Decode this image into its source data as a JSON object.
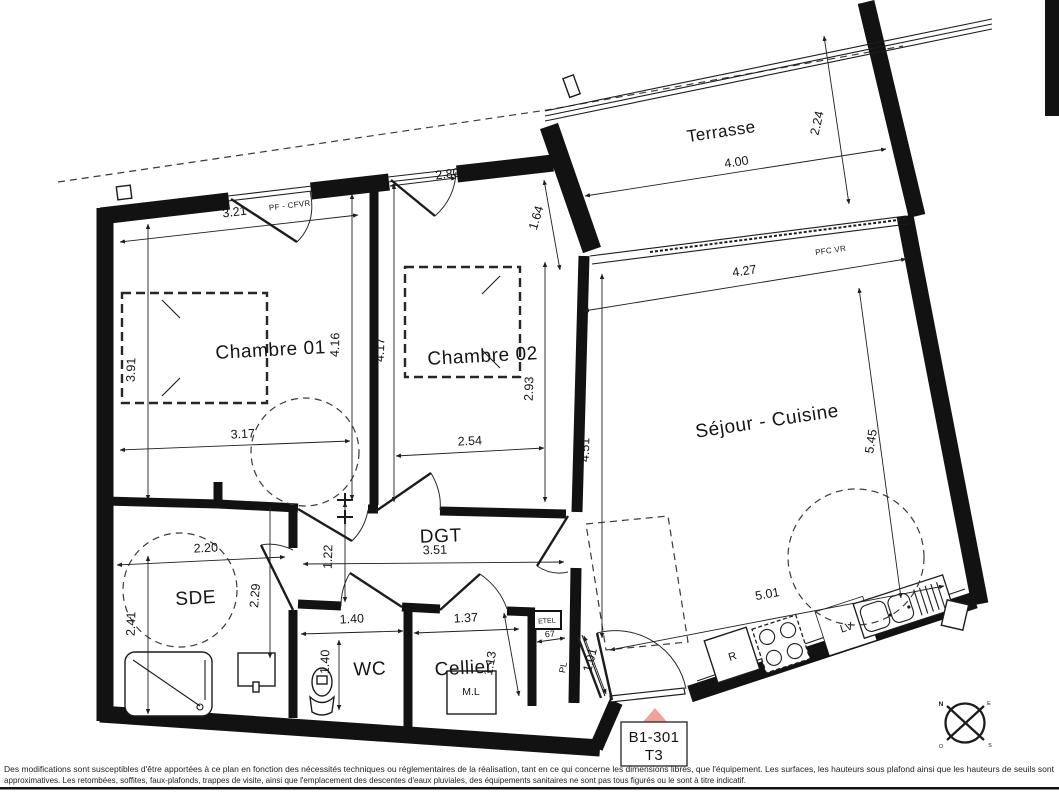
{
  "rooms": {
    "terrasse": "Terrasse",
    "chambre1": "Chambre 01",
    "chambre2": "Chambre 02",
    "sejour": "Séjour - Cuisine",
    "sde": "SDE",
    "wc": "WC",
    "cellier": "Cellier",
    "dgt": "DGT"
  },
  "dims": {
    "terrasse_w": "4.00",
    "terrasse_d": "2.24",
    "bay_w": "4.27",
    "sejour_left": "4.51",
    "sejour_right": "5.45",
    "kitchen_w": "5.01",
    "ch1_win": "3.21",
    "ch1_left": "3.91",
    "ch1_mid": "4.16",
    "ch1_low": "3.17",
    "ch2_win": "2.80",
    "ch2_left": "4.17",
    "ch2_right": "2.93",
    "ch2_low": "2.54",
    "wall_terrasse": "1.64",
    "sde_w": "2.20",
    "sde_left": "2.41",
    "sde_right": "2.29",
    "dgt_left": "1.22",
    "dgt_w": "3.51",
    "wc_w": "1.40",
    "wc_d": "1.40",
    "cellier_w": "1.37",
    "cellier_d": "1.13",
    "etel_w": "67",
    "pl_d": "1.01"
  },
  "labels": {
    "window_ch1": "PF - CFVR",
    "window_ch2": "PF - CF VR",
    "bay": "PFC VR",
    "closet": "PL",
    "tech_box": "ETEL",
    "washing_machine": "M.L",
    "fridge": "R",
    "dishwasher": "LV"
  },
  "unit": {
    "code": "B1-301",
    "type": "T3"
  },
  "compass": {
    "n": "N",
    "e": "E",
    "s": "S",
    "o": "O"
  },
  "colors": {
    "entrance_marker": "#f2a09c",
    "wall": "#121212",
    "north_red": "#cc2222"
  },
  "disclaimer": {
    "line1": "Des modifications sont susceptibles d'être apportées à ce plan en fonction des nécessités techniques ou réglementaires de la réalisation, tant en ce qui concerne les dimensions libres, que l'équipement. Les surfaces, les hauteurs sous plafond ainsi que les hauteurs de seuils sont",
    "line2": "approximatives. Les retombées, soffites, faux-plafonds, trappes de visite, ainsi que l'emplacement des descentes d'eaux pluviales, des équipements sanitaires ne sont pas tous figurés ou le sont à titre indicatif."
  }
}
